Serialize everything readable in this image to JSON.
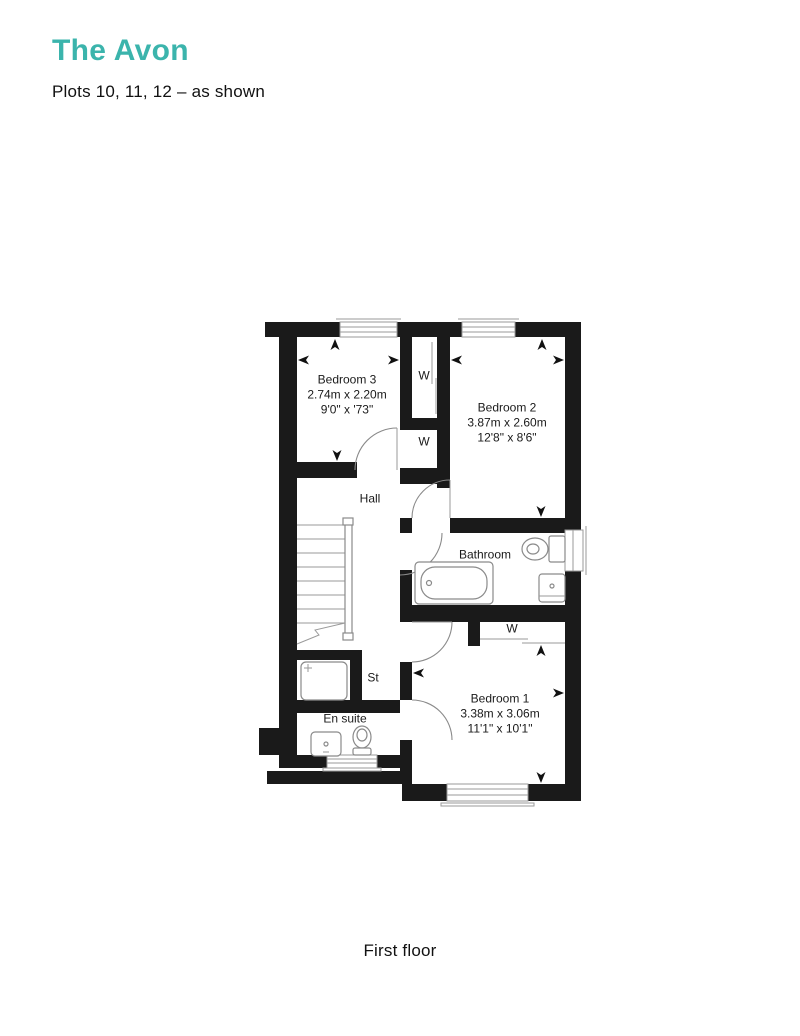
{
  "header": {
    "title": "The Avon",
    "subtitle": "Plots 10, 11, 12 – as shown"
  },
  "caption": "First floor",
  "colors": {
    "accent": "#3BB4AC",
    "wall": "#1A1A1A",
    "plan_lines": "#9A9A9A"
  },
  "rooms": {
    "bedroom3": {
      "name": "Bedroom 3",
      "metric": "2.74m x 2.20m",
      "imperial": "9'0\" x '73\""
    },
    "bedroom2": {
      "name": "Bedroom 2",
      "metric": "3.87m x 2.60m",
      "imperial": "12'8\" x 8'6\""
    },
    "bedroom1": {
      "name": "Bedroom 1",
      "metric": "3.38m x 3.06m",
      "imperial": "11'1\" x 10'1\""
    },
    "hall": {
      "name": "Hall"
    },
    "bathroom": {
      "name": "Bathroom"
    },
    "ensuite": {
      "name": "En suite"
    },
    "storage": {
      "name": "St"
    },
    "wardrobe": {
      "label": "W"
    }
  }
}
